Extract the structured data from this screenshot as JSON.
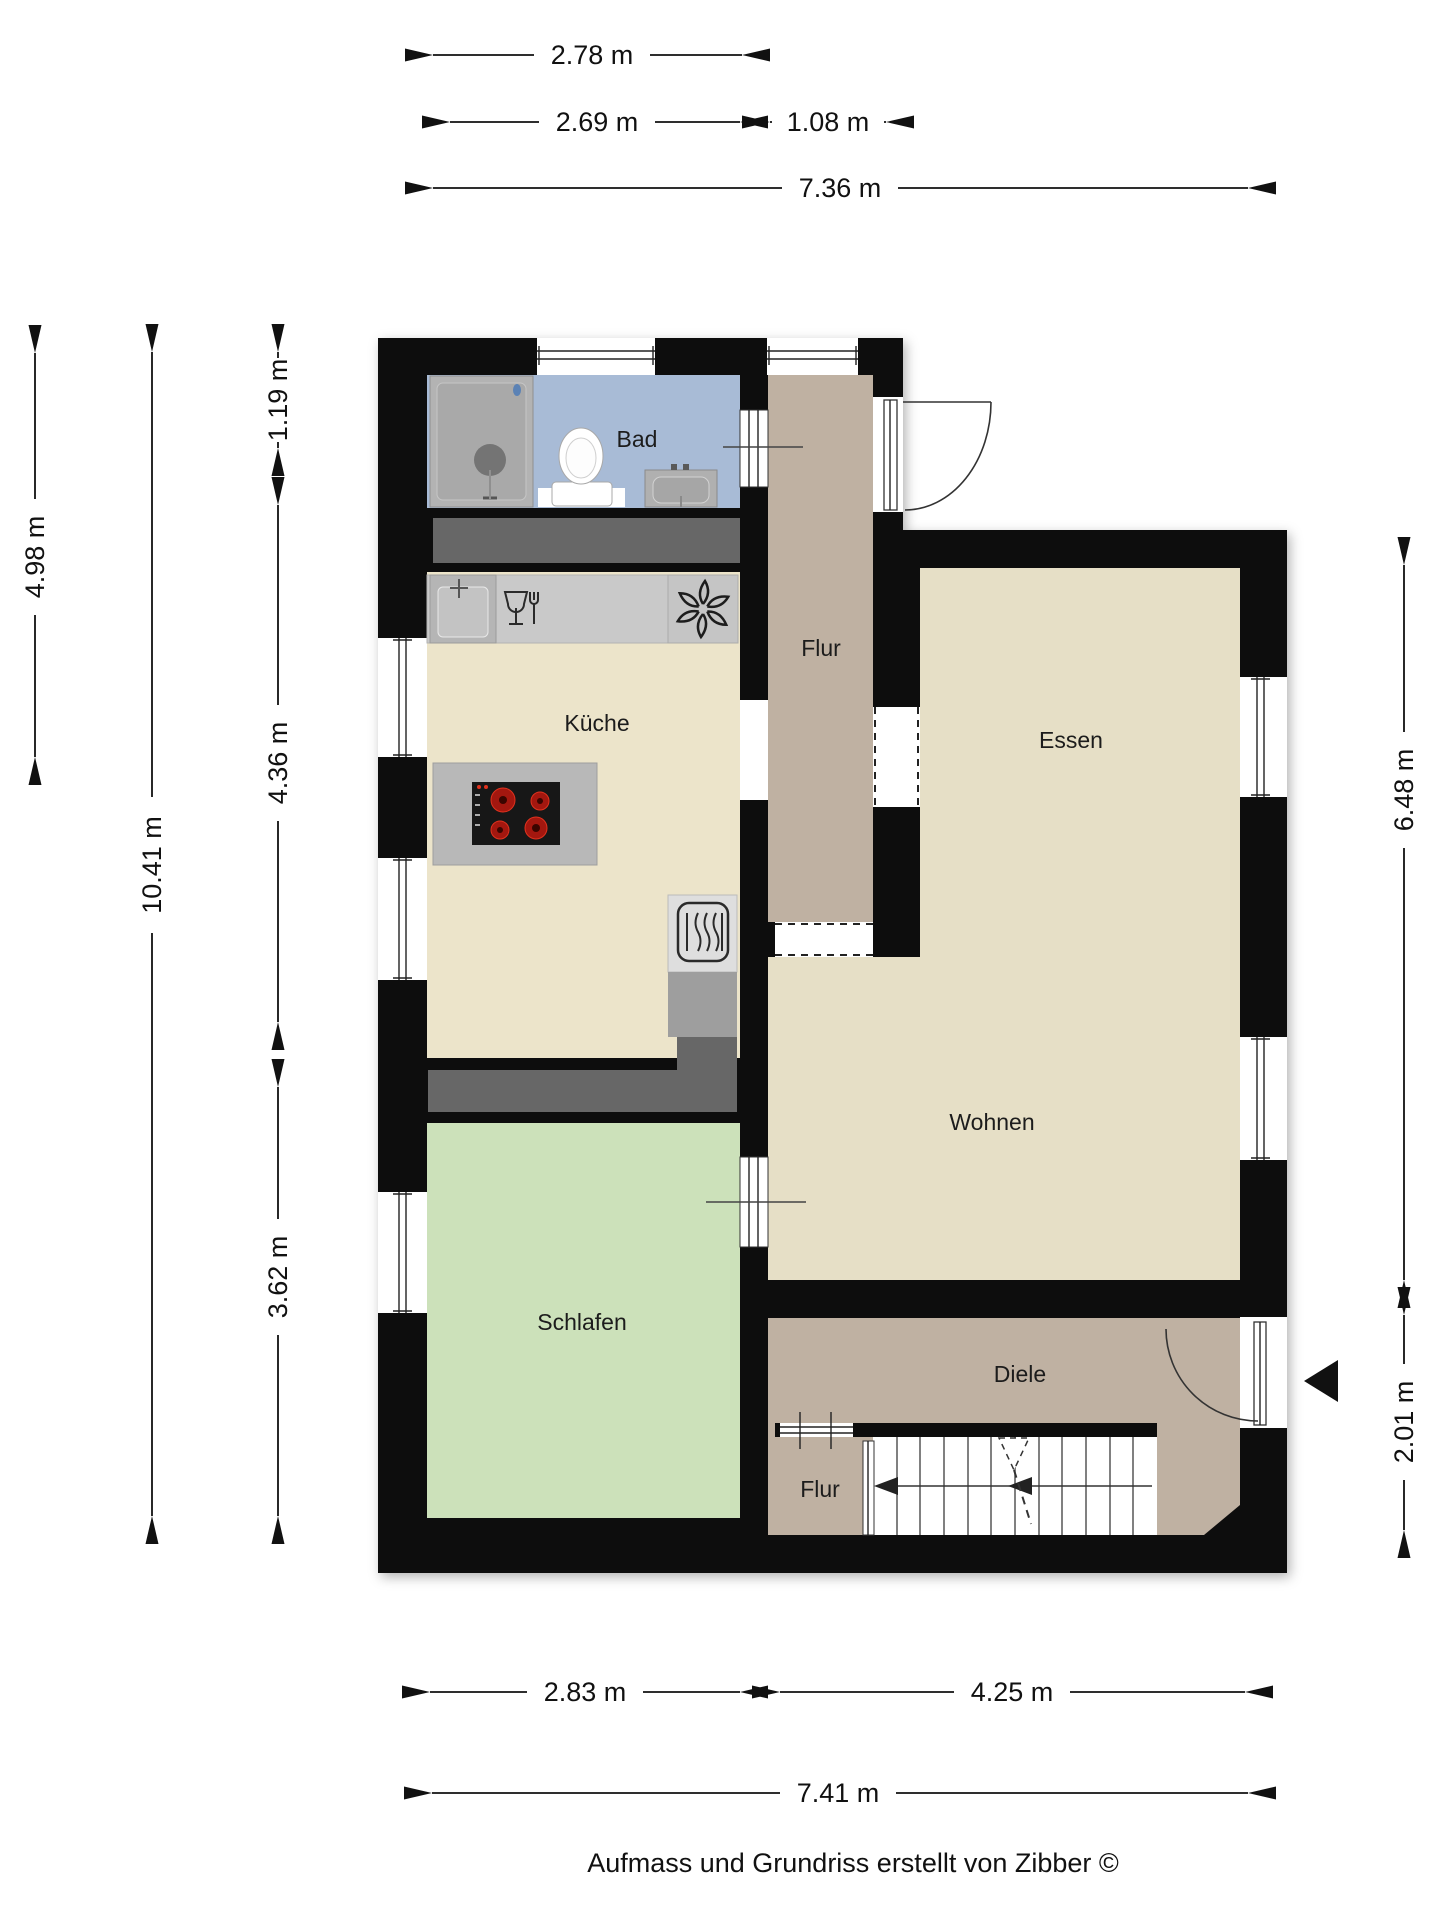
{
  "footer": "Aufmass und Grundriss erstellt von Zibber ©",
  "rooms": {
    "bad": "Bad",
    "flur_top": "Flur",
    "kueche": "Küche",
    "essen": "Essen",
    "wohnen": "Wohnen",
    "schlafen": "Schlafen",
    "diele": "Diele",
    "flur_bottom": "Flur"
  },
  "dimensions": {
    "top": [
      "2.78 m",
      "2.69 m",
      "1.08 m",
      "7.36 m"
    ],
    "bottom": [
      "2.83 m",
      "4.25 m",
      "7.41 m"
    ],
    "left": [
      "4.98 m",
      "10.41 m",
      "1.19 m",
      "4.36 m",
      "3.62 m"
    ],
    "right": [
      "6.48 m",
      "2.01 m"
    ]
  },
  "colors": {
    "wall": "#0d0d0d",
    "bad": "#a8bbd6",
    "kueche": "#ece4ca",
    "essen": "#e6dfc6",
    "wohnen": "#e6dfc6",
    "flur": "#bfb1a2",
    "diele": "#bfb1a2",
    "schlafen": "#cce1ba",
    "counter": "#c9c9c9",
    "cabinet": "#9e9e9e",
    "wardrobe": "#676767",
    "burner": "#c9231a"
  },
  "icons": [
    "shower-icon",
    "toilet-icon",
    "washbasin-icon",
    "kitchen-sink-icon",
    "faucet-icon",
    "dishwasher-icon",
    "extractor-fan-icon",
    "stove-icon",
    "oven-icon",
    "stair-direction-arrow-icon",
    "stair-start-triangle-icon",
    "entrance-arrow-icon",
    "door-swing-arc-icon",
    "window-glazing-icon"
  ]
}
